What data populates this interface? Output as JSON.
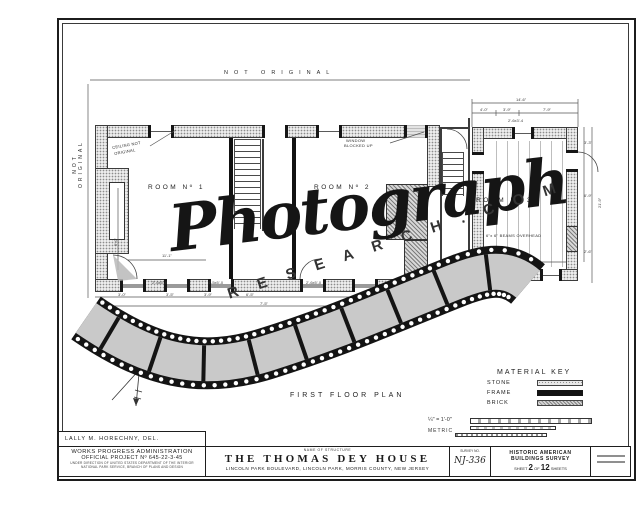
{
  "colors": {
    "ink": "#1c1c1c",
    "film_black": "#141414",
    "film_gray": "#c9c9c9",
    "stone_fill": "#ececec"
  },
  "watermark": {
    "script_text": "Photograph",
    "domain_text": "R E S E A R C H . C O M"
  },
  "margins": {
    "top_note": "NOT ORIGINAL",
    "left_note": "NOT ORIGINAL"
  },
  "plan": {
    "title": "FIRST FLOOR PLAN",
    "labels": [
      {
        "t": "ROOM Nº 1",
        "x": 148,
        "y": 184,
        "cls": "room"
      },
      {
        "t": "ROOM Nº 2",
        "x": 314,
        "y": 184,
        "cls": "room"
      },
      {
        "t": "ROOM Nº 3",
        "x": 476,
        "y": 197,
        "cls": "room"
      },
      {
        "t": "CEILING NOT",
        "x": 112,
        "y": 146,
        "r": -10,
        "cls": "note"
      },
      {
        "t": "ORIGINAL",
        "x": 114,
        "y": 152,
        "r": -10,
        "cls": "note"
      },
      {
        "t": "WINDOW",
        "x": 346,
        "y": 139,
        "cls": "note"
      },
      {
        "t": "BLOCKED UP",
        "x": 344,
        "y": 144,
        "cls": "note"
      },
      {
        "t": "6\"x 6\" BEAMS OVERHEAD",
        "x": 486,
        "y": 234,
        "cls": "note"
      },
      {
        "t": "14'-6\"",
        "x": 516,
        "y": 98,
        "cls": "dim"
      },
      {
        "t": "4'-0\"",
        "x": 480,
        "y": 108,
        "cls": "dim"
      },
      {
        "t": "3'-9\"",
        "x": 503,
        "y": 108,
        "cls": "dim"
      },
      {
        "t": "7'-9\"",
        "x": 543,
        "y": 108,
        "cls": "dim"
      },
      {
        "t": "2'-6x3'-4",
        "x": 508,
        "y": 119,
        "cls": "dim"
      },
      {
        "t": "21'-9\"",
        "x": 598,
        "y": 208,
        "r": -90,
        "cls": "dim"
      },
      {
        "t": "3'-3\"",
        "x": 584,
        "y": 141,
        "cls": "dim"
      },
      {
        "t": "6'-9\"",
        "x": 584,
        "y": 194,
        "cls": "dim"
      },
      {
        "t": "2'-6\"",
        "x": 584,
        "y": 250,
        "cls": "dim"
      },
      {
        "t": "20'-9\"",
        "x": 512,
        "y": 253,
        "cls": "dim"
      },
      {
        "t": "11'-1\"",
        "x": 162,
        "y": 254,
        "cls": "dim"
      },
      {
        "t": "5'-0\"",
        "x": 114,
        "y": 246,
        "r": -90,
        "cls": "dim"
      },
      {
        "t": "2'-6x5'-0",
        "x": 152,
        "y": 281,
        "cls": "dim"
      },
      {
        "t": "4'-5x5'-0",
        "x": 208,
        "y": 281,
        "cls": "dim"
      },
      {
        "t": "2'-6x5'-0",
        "x": 306,
        "y": 281,
        "cls": "dim"
      },
      {
        "t": "3'-0\"",
        "x": 118,
        "y": 293,
        "cls": "dim"
      },
      {
        "t": "3'-5\"",
        "x": 166,
        "y": 293,
        "cls": "dim"
      },
      {
        "t": "3'-9\"",
        "x": 204,
        "y": 293,
        "cls": "dim"
      },
      {
        "t": "6'-5\"",
        "x": 246,
        "y": 293,
        "cls": "dim"
      },
      {
        "t": "7'-5\"",
        "x": 260,
        "y": 302,
        "cls": "dim"
      },
      {
        "t": "5'-6\"",
        "x": 489,
        "y": 292,
        "cls": "dim"
      }
    ]
  },
  "material_key": {
    "title": "MATERIAL KEY",
    "items": [
      {
        "label": "STONE"
      },
      {
        "label": "FRAME"
      },
      {
        "label": "BRICK"
      }
    ]
  },
  "scale": {
    "imperial": "¼\" = 1'-0\"",
    "metric": "METRIC"
  },
  "titleblock": {
    "delineator": "LALLY M. HORECHNY, DEL.",
    "wpa_line1": "WORKS PROGRESS ADMINISTRATION",
    "wpa_line2": "OFFICIAL PROJECT Nº 645-22-3-45",
    "wpa_fine1": "UNDER DIRECTION OF UNITED STATES DEPARTMENT OF THE INTERIOR",
    "wpa_fine2": "NATIONAL PARK SERVICE, BRANCH OF PLANS AND DESIGN",
    "name_label": "NAME OF STRUCTURE",
    "structure_name": "THE  THOMAS  DEY  HOUSE",
    "address": "LINCOLN PARK BOULEVARD, LINCOLN PARK, MORRIS COUNTY,  NEW JERSEY",
    "survey_label": "SURVEY NO.",
    "survey_no": "NJ-336",
    "habs_line1": "HISTORIC AMERICAN",
    "habs_line2": "BUILDINGS SURVEY",
    "sheet_prefix": "SHEET",
    "sheet_no": "2",
    "sheet_mid": "OF",
    "sheet_total": "12",
    "sheet_suffix": "SHEETS"
  }
}
